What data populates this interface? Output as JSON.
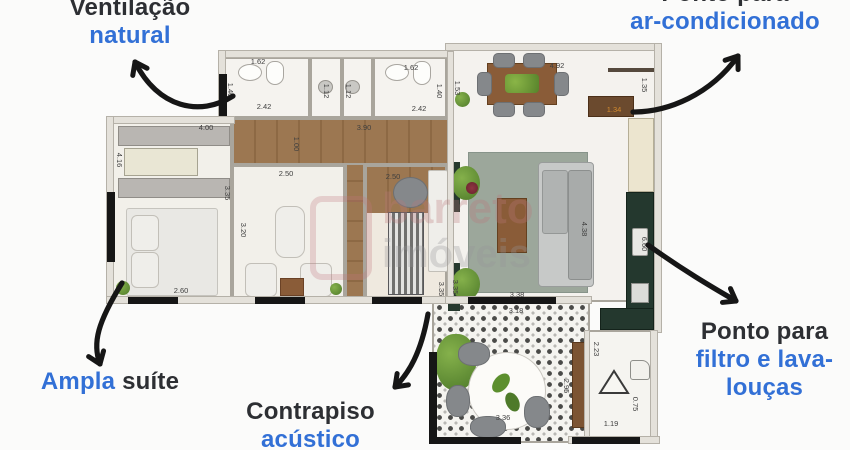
{
  "annotations": {
    "ventilation": {
      "line1": "Ventilação",
      "line2": "natural"
    },
    "ac": {
      "line1": "Ponto para",
      "line2": "ar-condicionado"
    },
    "suite": {
      "word_blue": "Ampla",
      "word_dark": "suíte"
    },
    "screed": {
      "line1": "Contrapiso",
      "line2": "acústico"
    },
    "sink_point": {
      "line1": "Ponto para",
      "line2": "filtro e lava-",
      "line3": "louças"
    }
  },
  "watermark": {
    "line1": "barreto",
    "line2": "imóveis"
  },
  "colors": {
    "annotation_dark": "#2d2f33",
    "annotation_blue": "#3270d6",
    "arrow": "#161616",
    "wood_floor": "#96714b",
    "kitchen_counter_green": "#24382e",
    "living_rug": "#9ca79b",
    "balcony_floor": "#f5f4f0",
    "dimension_text": "#3f3f3f",
    "dimension_accent": "#d28a2e"
  },
  "plan": {
    "dimensions": [
      {
        "t": "1.62",
        "x": 258,
        "y": 62,
        "v": 0
      },
      {
        "t": "1.40",
        "x": 230,
        "y": 90,
        "v": 1
      },
      {
        "t": "2.42",
        "x": 264,
        "y": 107,
        "v": 0
      },
      {
        "t": "1.12",
        "x": 326,
        "y": 91,
        "v": 1
      },
      {
        "t": "1.12",
        "x": 348,
        "y": 91,
        "v": 1
      },
      {
        "t": "1.62",
        "x": 411,
        "y": 68,
        "v": 0
      },
      {
        "t": "2.42",
        "x": 419,
        "y": 109,
        "v": 0
      },
      {
        "t": "1.40",
        "x": 439,
        "y": 91,
        "v": 1
      },
      {
        "t": "4.00",
        "x": 206,
        "y": 128,
        "v": 0
      },
      {
        "t": "3.90",
        "x": 364,
        "y": 128,
        "v": 0
      },
      {
        "t": "1.00",
        "x": 296,
        "y": 144,
        "v": 1
      },
      {
        "t": "4.92",
        "x": 557,
        "y": 66,
        "v": 0
      },
      {
        "t": "1.53",
        "x": 457,
        "y": 88,
        "v": 1
      },
      {
        "t": "1.35",
        "x": 644,
        "y": 85,
        "v": 1
      },
      {
        "t": "1.34",
        "x": 614,
        "y": 110,
        "v": 0,
        "c": "#d28a2e"
      },
      {
        "t": "4.16",
        "x": 119,
        "y": 160,
        "v": 1
      },
      {
        "t": "3.35",
        "x": 227,
        "y": 193,
        "v": 1
      },
      {
        "t": "2.50",
        "x": 286,
        "y": 174,
        "v": 0
      },
      {
        "t": "3.20",
        "x": 243,
        "y": 230,
        "v": 1
      },
      {
        "t": "2.60",
        "x": 181,
        "y": 291,
        "v": 0
      },
      {
        "t": "2.50",
        "x": 393,
        "y": 177,
        "v": 0
      },
      {
        "t": "3.35",
        "x": 455,
        "y": 287,
        "v": 1
      },
      {
        "t": "4.38",
        "x": 584,
        "y": 229,
        "v": 1
      },
      {
        "t": "6.60",
        "x": 644,
        "y": 244,
        "v": 1
      },
      {
        "t": "3.38",
        "x": 517,
        "y": 295,
        "v": 0
      },
      {
        "t": "3.35",
        "x": 441,
        "y": 289,
        "v": 1
      },
      {
        "t": "3.18",
        "x": 516,
        "y": 311,
        "v": 0
      },
      {
        "t": "2.95",
        "x": 566,
        "y": 386,
        "v": 1
      },
      {
        "t": "3.36",
        "x": 503,
        "y": 418,
        "v": 0
      },
      {
        "t": "2.23",
        "x": 596,
        "y": 349,
        "v": 1
      },
      {
        "t": "1.19",
        "x": 611,
        "y": 424,
        "v": 0
      },
      {
        "t": "0.75",
        "x": 635,
        "y": 404,
        "v": 1
      }
    ]
  }
}
